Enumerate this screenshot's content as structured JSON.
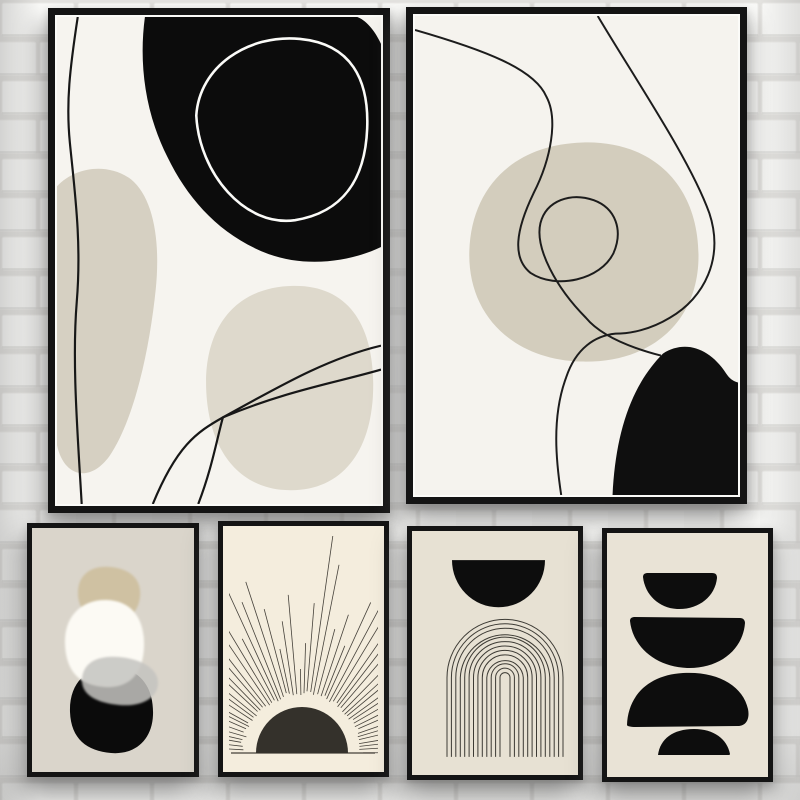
{
  "scene": {
    "description": "Product photo: six black-framed abstract mid-century boho posters hung in two rows on a white painted brick wall",
    "visible_text": "none"
  },
  "wall": {
    "brick_color": "#f9f9f7",
    "brick_color_alt": "#f6f6f4",
    "mortar_color": "#e3e2df",
    "brick_edge_color": "#ecebe8"
  },
  "frame": {
    "color": "#141414",
    "mat_color": "#fbfbf8"
  },
  "palette": {
    "ink_line": "#1a1a1a",
    "black_shape": "#0d0d0d",
    "off_white_bg": "#f6f4ef",
    "beige_blob": "#d6d0c2",
    "beige_blob_light": "#ded9cc",
    "beige_blob_right": "#d3cdbd",
    "pebbles_bg": "#dad5cb",
    "tan_blob": "#cfc1a2",
    "white_blob": "#fcfaf4",
    "gray_blob": "rgba(196,195,192,0.85)",
    "sun_bg": "#f4eddd",
    "arch_bg": "#e7e1d3",
    "stones_bg": "#e9e3d6"
  },
  "posters": [
    {
      "name": "abstract-blobs-line-art-large-left",
      "shapes": [
        "black organic blob with white ring outline",
        "two beige blobs",
        "wavy vertical line",
        "two crossing sweep lines"
      ]
    },
    {
      "name": "abstract-loop-line-art-large-right",
      "shapes": [
        "large beige blob",
        "looping black line",
        "sweeping black line",
        "black corner blob"
      ]
    },
    {
      "name": "stacked-organic-pebbles",
      "shapes": [
        "tan blob",
        "white blob",
        "translucent gray blob",
        "black blob"
      ]
    },
    {
      "name": "woodcut-sunrise",
      "sun": {
        "cx": 79,
        "cy": 227,
        "inner_radius": 57,
        "ray_count": 56,
        "min_len": 26,
        "max_len": 175,
        "ray_color": "#45413a",
        "disc_color": "#34312b",
        "baseline_color": "#45413a"
      }
    },
    {
      "name": "arch-line-drawing",
      "arch": {
        "cx": 93,
        "center_y": 146,
        "base_y": 225,
        "outer_radius": 58,
        "inner_radius": 5,
        "count": 13,
        "color": "#3c3a34"
      },
      "half_circle_color": "#0d0d0d"
    },
    {
      "name": "balanced-black-stones",
      "shapes": [
        "small bowl",
        "large bowl",
        "dome",
        "small dome"
      ]
    }
  ]
}
